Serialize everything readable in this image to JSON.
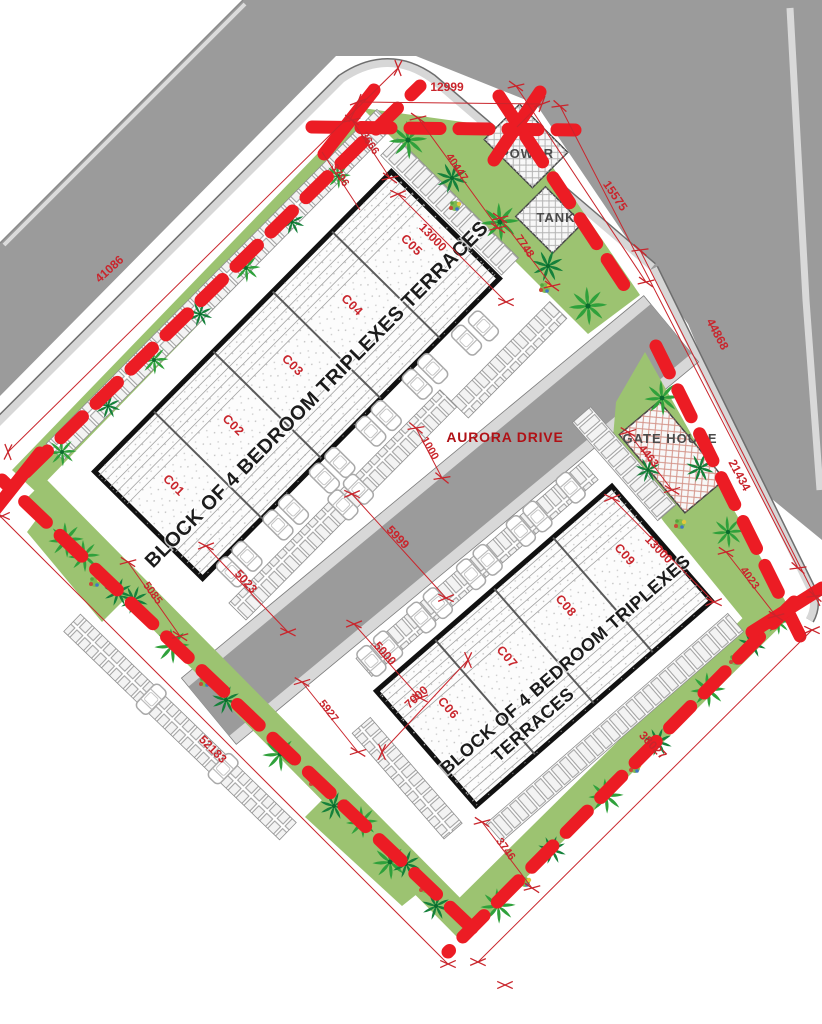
{
  "roads": {
    "aurora_drive": "AURORA DRIVE"
  },
  "structures": {
    "power": "POWER",
    "tank": "TANK",
    "gate_house": "GATE HOUSE"
  },
  "blocks": [
    {
      "title": "BLOCK OF 4 BEDROOM TRIPLEXES TERRACES",
      "units": [
        "C01",
        "C02",
        "C03",
        "C04",
        "C05"
      ]
    },
    {
      "title_line1": "BLOCK OF 4 BEDROOM TRIPLEXES",
      "title_line2": "TERRACES",
      "units": [
        "C06",
        "C07",
        "C08",
        "C09"
      ]
    }
  ],
  "dimensions": {
    "top_chamfer": "12999",
    "northwest_boundary": "41086",
    "northeast_boundary": "15575",
    "east_road": "44868",
    "east_boundary": "21434",
    "southwest_boundary": "52183",
    "southeast_boundary": "38027",
    "block1_width": "13000",
    "block2_width": "13000",
    "road_width": "5999",
    "road_offset": "1000",
    "block2_unit": "7000",
    "parking_bay": "5000",
    "block1_edge": "5023",
    "west_corner": "5085",
    "block2_west": "5927",
    "block2_south": "3746",
    "block2_east": "4023",
    "north_corner_a": "3666",
    "north_corner_b": "3796",
    "north_strip": "40447",
    "tank_offset": "7748",
    "gate_offset": "4463"
  },
  "colors": {
    "boundary_red": "#EC1C24",
    "dimension_red": "#C9252C",
    "road_gray": "#9B9B9B",
    "landscape_green": "#9CC371"
  }
}
